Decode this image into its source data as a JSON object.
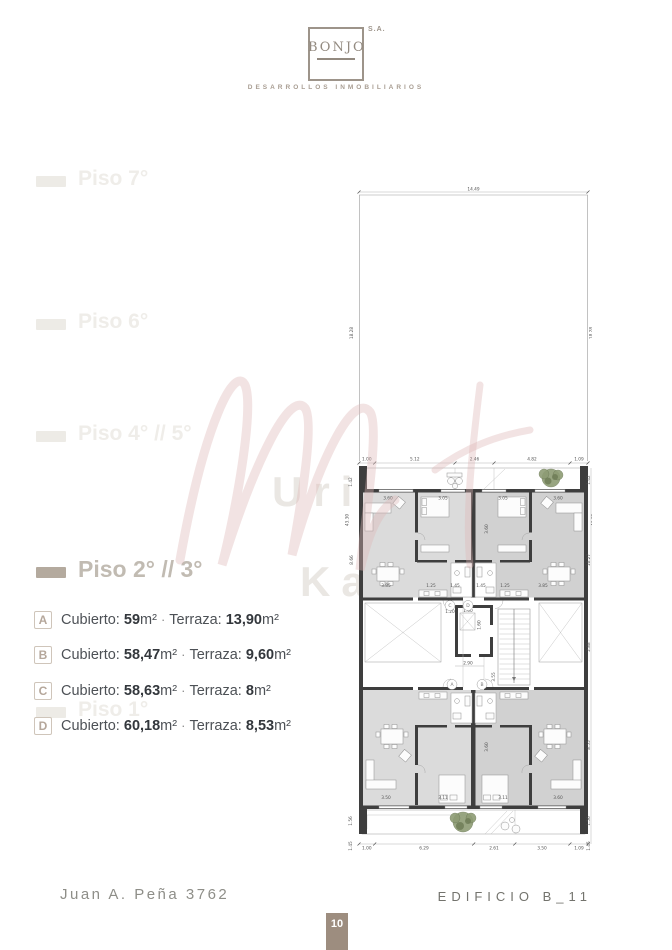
{
  "logo": {
    "name": "BONJO",
    "suffix": "S.A.",
    "tagline": "DESARROLLOS INMOBILIARIOS"
  },
  "sidebar": {
    "items": [
      {
        "label": "Piso 7°",
        "active": false
      },
      {
        "label": "Piso 6°",
        "active": false
      },
      {
        "label": "Piso 4° // 5°",
        "active": false
      },
      {
        "label": "Piso 2° // 3°",
        "active": true
      },
      {
        "label": "Piso 1°",
        "active": false
      }
    ]
  },
  "units": {
    "cubierto_label": "Cubierto:",
    "terraza_label": "Terraza:",
    "unit_suffix": "m²",
    "separator": "·",
    "rows": [
      {
        "letter": "A",
        "cubierto": "59",
        "terraza": "13,90"
      },
      {
        "letter": "B",
        "cubierto": "58,47",
        "terraza": "9,60"
      },
      {
        "letter": "C",
        "cubierto": "58,63",
        "terraza": "8"
      },
      {
        "letter": "D",
        "cubierto": "60,18",
        "terraza": "8,53"
      }
    ]
  },
  "watermark": {
    "line1": "Uria",
    "line2": "Ka"
  },
  "plan": {
    "overall_width": "14.49",
    "upper_height": "18.28",
    "top_row": [
      "1.00",
      "5.12",
      "2.46",
      "4.82",
      "1.09"
    ],
    "bottom_row": [
      "1.00",
      "6.29",
      "2.61",
      "3.50",
      "1.09"
    ],
    "left_side": [
      "1.42",
      "43.30",
      "8.66",
      "1.56",
      "1.45"
    ],
    "right_side": [
      "1.42",
      "43.30",
      "10.27",
      "2.88",
      "8.55",
      "1.56",
      "1.45"
    ],
    "upper_rooms": [
      "3.60",
      "3.05",
      "3.05",
      "3.60"
    ],
    "mid_row": [
      "3.85",
      "1.25",
      "1.45",
      "1.45",
      "1.25",
      "3.85"
    ],
    "lower_rooms": [
      "3.50",
      "3.11",
      "3.11",
      "3.60"
    ],
    "room_depth": "3.60",
    "core": {
      "a": "1.20",
      "b": "1.00",
      "c": "1.60",
      "d": "2.90",
      "e": "3.55"
    },
    "unit_circles": [
      "C",
      "D",
      "A",
      "B"
    ]
  },
  "footer": {
    "address": "Juan A. Peña 3762",
    "building": "EDIFICIO B_11",
    "page_number": "10"
  }
}
